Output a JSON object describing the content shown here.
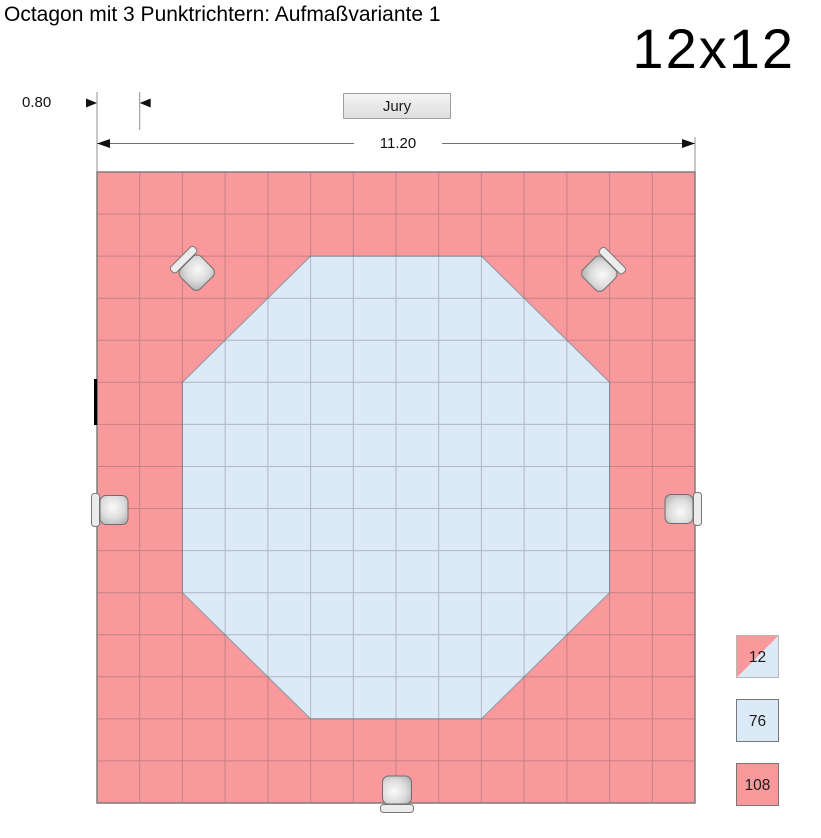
{
  "header": {
    "title": "Octagon mit 3 Punktrichtern: Aufmaßvariante 1",
    "size_label": "12x12"
  },
  "dimensions": {
    "cell_width_label": "0.80",
    "total_width_label": "11.20"
  },
  "jury": {
    "label": "Jury"
  },
  "legend": {
    "items": [
      {
        "value": "12",
        "type": "half-red-half-blue-tile"
      },
      {
        "value": "76",
        "type": "blue-tile"
      },
      {
        "value": "108",
        "type": "red-tile"
      }
    ]
  },
  "colors": {
    "mat_red": "#FA999B",
    "mat_blue": "#DCE9F6",
    "grid_line": "rgba(85,85,95,0.33)",
    "octagon_outline": "#8A97A8",
    "grid_border": "#7D7D7D",
    "dimension_line": "#707070",
    "extension_line": "#909090",
    "arrow": "#111111",
    "tick": "#000000"
  },
  "diagram": {
    "grid": {
      "x": 97,
      "y": 172,
      "cols": 14,
      "rows": 15,
      "cell_w": 42.714,
      "cell_h": 42.067
    },
    "octagon": {
      "col": 2,
      "row": 2,
      "cols": 10,
      "rows": 11,
      "corner_cut": 3
    },
    "chairs": [
      {
        "name": "judge-chair-top-left",
        "x": 196,
        "y": 272,
        "rot": 45
      },
      {
        "name": "judge-chair-top-right",
        "x": 600,
        "y": 273,
        "rot": 135
      },
      {
        "name": "judge-chair-left",
        "x": 113,
        "y": 510,
        "rot": 0
      },
      {
        "name": "judge-chair-right",
        "x": 680,
        "y": 509,
        "rot": 180
      },
      {
        "name": "judge-chair-bottom",
        "x": 397,
        "y": 791,
        "rot": 270
      }
    ],
    "tick": {
      "x": 94,
      "y": 379,
      "w": 3.2,
      "h": 46
    }
  }
}
